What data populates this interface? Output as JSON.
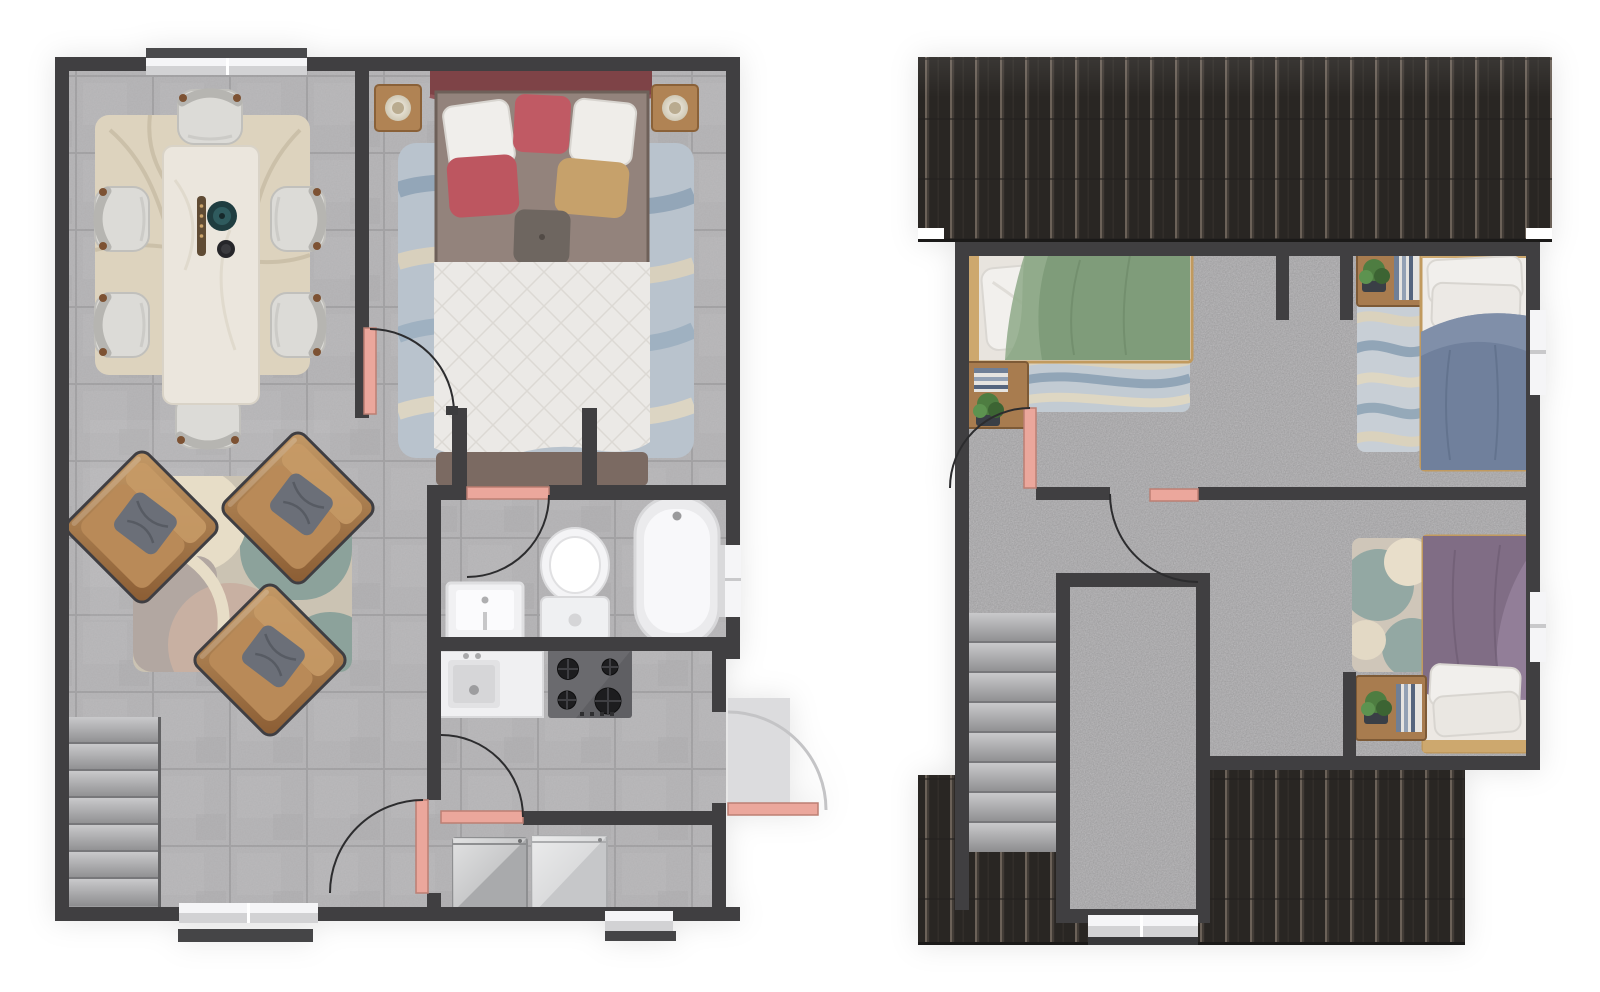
{
  "app": {
    "type": "floor-plan-rendering",
    "floors_count": 2
  },
  "palette": {
    "wall": "#403f41",
    "tile_floor": "#b6b5b7",
    "tile_line": "#a4a3a5",
    "carpet": "#b1b0b2",
    "roof_dark": "#292623",
    "roof_ridge": "#6b6158",
    "door_leaf": "#eba79c",
    "door_leaf_edge": "#bc7f73",
    "swing_arc": "#2c2c2e",
    "window_white": "#f5f5f7",
    "window_band": "#d2d2d4",
    "rug_dining": "#ddd3be",
    "rug_dining_curve": "#c9bea7",
    "rug_bed_blue": "#b9c3cd",
    "rug_wave_slate": "#8fa3b6",
    "rug_wave_cream": "#dcd2bc",
    "rug_living_base": "#cbc3b3",
    "rug_living_teal": "#8ca29b",
    "rug_living_cream": "#e7ddc7",
    "rug_living_pink": "#c8b0a2",
    "rug_living_mauve": "#b2a7a1",
    "leather_chair_light": "#c49a67",
    "leather_chair_dark": "#8a5c33",
    "chair_seat": "#dcdbd7",
    "wood_dark": "#7d5233",
    "wood_nightstand": "#a87c4f",
    "bed_frame_tan": "#c19a5e",
    "headboard_maroon": "#7e4347",
    "bed_body_brown": "#93837c",
    "pillow_white": "#f0eeeb",
    "pillow_red": "#c05a64",
    "pillow_tan": "#c6a16b",
    "pillow_gray": "#6e6660",
    "duvet_white": "#ebe9e6",
    "duvet_green": "#7f9c7a",
    "duvet_green_light": "#93ad8d",
    "duvet_blue": "#70809c",
    "duvet_blue_light": "#8292ac",
    "duvet_purple": "#806d85",
    "duvet_purple_light": "#93809a",
    "fixture_white": "#f1f1f3",
    "stove_dark": "#5f5f63",
    "burner_black": "#1d1d1f",
    "washer_gray": "#a9aaac",
    "dryer_gray": "#c6c7c9",
    "stair_light": "#c9c9cb",
    "stair_dark": "#8d8d8f",
    "porch_gray": "#dcdcde",
    "plant_green": "#4e7d41",
    "book_blue": "#6f7f96"
  },
  "floors": [
    {
      "id": "ground-floor",
      "position": "left",
      "rooms": [
        {
          "name": "dining-area",
          "furniture": [
            "dining-table",
            "dining-chair-x6",
            "area-rug",
            "table-decor"
          ]
        },
        {
          "name": "living-area",
          "furniture": [
            "armchair-x3",
            "area-rug"
          ]
        },
        {
          "name": "bedroom",
          "furniture": [
            "double-bed",
            "nightstand-x2",
            "table-lamp-x2",
            "area-rug"
          ]
        },
        {
          "name": "bathroom",
          "furniture": [
            "bathtub",
            "toilet",
            "sink"
          ]
        },
        {
          "name": "kitchen",
          "furniture": [
            "sink-counter",
            "gas-hob-4-burners"
          ]
        },
        {
          "name": "laundry-room",
          "furniture": [
            "washer",
            "dryer"
          ]
        },
        {
          "name": "staircase",
          "furniture": [
            "stairs-7-treads"
          ]
        }
      ],
      "doors": 5,
      "windows": 4,
      "entry_porch": true
    },
    {
      "id": "upper-floor",
      "position": "right",
      "rooms": [
        {
          "name": "bedroom-green",
          "furniture": [
            "double-bed-green",
            "nightstand",
            "books",
            "plant",
            "area-rug"
          ]
        },
        {
          "name": "bedroom-blue",
          "furniture": [
            "single-bed-blue",
            "nightstand",
            "books",
            "plant",
            "area-rug"
          ]
        },
        {
          "name": "bedroom-purple",
          "furniture": [
            "single-bed-purple",
            "nightstand",
            "books",
            "plant",
            "area-rug"
          ]
        },
        {
          "name": "hallway",
          "furniture": []
        },
        {
          "name": "staircase",
          "furniture": [
            "stairs-8-treads"
          ]
        }
      ],
      "doors": 3,
      "windows": 3,
      "roof_sections": 2
    }
  ]
}
